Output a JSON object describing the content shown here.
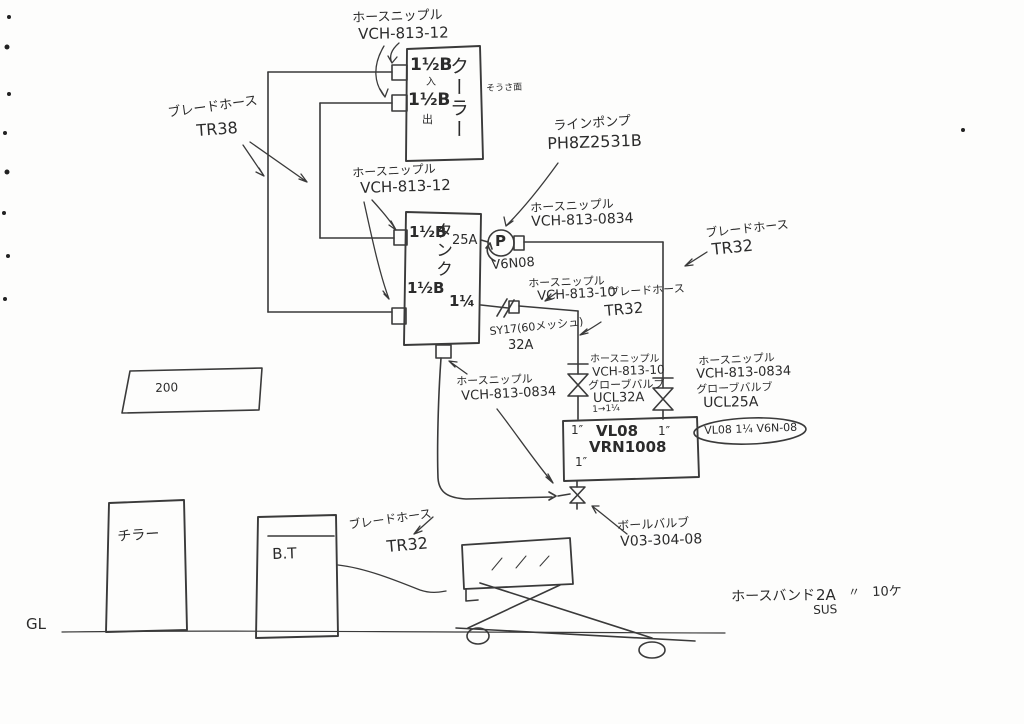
{
  "ink": "#2f2f2f",
  "labels": {
    "cooler_nipple": {
      "l1": "ホースニップル",
      "l2": "VCH-813-12"
    },
    "blade_hose_tr38": {
      "l1": "ブレードホース",
      "l2": "TR38"
    },
    "tank_nipple": {
      "l1": "ホースニップル",
      "l2": "VCH-813-12"
    },
    "line_pump": {
      "l1": "ラインポンプ",
      "l2": "PH8Z2531B"
    },
    "pump_nipple": {
      "l1": "ホースニップル",
      "l2": "VCH-813-0834"
    },
    "blade_hose_tr32_right": {
      "l1": "ブレードホース",
      "l2": "TR32"
    },
    "mid_nipple": {
      "l1": "ホースニップル",
      "l2": "VCH-813-10"
    },
    "blade_hose_tr32_mid": {
      "l1": "ブレードホース",
      "l2": "TR32"
    },
    "strainer": {
      "l1": "SY17(60メッシュ)",
      "l2": "32A"
    },
    "tank_bottom_nipple": {
      "l1": "ホースニップル",
      "l2": "VCH-813-0834"
    },
    "globe_valve_left": {
      "l1": "ホースニップル",
      "l2": "VCH-813-10",
      "l3": "グローブバルブ",
      "l4": "UCL32A",
      "note": "1→1¼"
    },
    "globe_valve_right": {
      "l1": "ホースニップル",
      "l2": "VCH-813-0834",
      "l3": "グローブバルブ",
      "l4": "UCL25A"
    },
    "oval_note": "VL08 1¼ V6N-08",
    "ball_valve": {
      "l1": "ボールバルブ",
      "l2": "V03-304-08"
    },
    "blade_hose_tr32_bottom": {
      "l1": "ブレードホース",
      "l2": "TR32"
    },
    "hose_band": {
      "name": "ホースバンド",
      "size": "2A",
      "ditto": "〃",
      "qty": "10ケ",
      "material": "SUS"
    },
    "gl": "GL",
    "dim_200": "200"
  },
  "equipment": {
    "cooler": {
      "name": "クーラー",
      "port_in": "1½B",
      "in_mark": "入",
      "port_out": "1½B",
      "out_mark": "出",
      "side_note": "そうさ面"
    },
    "tank": {
      "name": "タンク",
      "size": "25A",
      "port_top": "1½B",
      "port_mid": "1½B",
      "port_bottom": "1¼"
    },
    "pump": {
      "symbol": "P",
      "model": "V6N08"
    },
    "machine": {
      "port_left": "1″",
      "name": "VL08",
      "model": "VRN1008",
      "port_right": "1″",
      "port_bottom": "1″"
    },
    "chiller": "チラー",
    "bt_box": "B.T"
  }
}
